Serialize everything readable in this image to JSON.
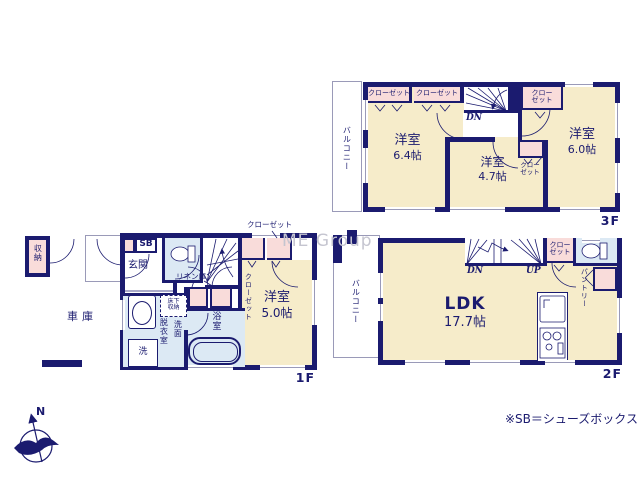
{
  "watermark": "ME Group",
  "footnote": "※SB＝シューズボックス",
  "compass": {
    "north": "N"
  },
  "colors": {
    "wall": "#1b1b6f",
    "room_fill": "#f6ecca",
    "closet_fill": "#f9dcda",
    "wet_area_fill": "#dce9f4",
    "balcony_outline": "#9a9ab8",
    "watermark": "#c5c5d0"
  },
  "floor3": {
    "label": "3F",
    "balcony": "バルコニー",
    "closet_a": "クローゼット",
    "closet_b": "クローゼット",
    "closet_c_line1": "クロー",
    "closet_c_line2": "ゼット",
    "closet_d_line1": "クロー",
    "closet_d_line2": "ゼット",
    "stairs_down": "DN",
    "room_a_name": "洋室",
    "room_a_size": "6.4帖",
    "room_b_name": "洋室",
    "room_b_size": "4.7帖",
    "room_c_name": "洋室",
    "room_c_size": "6.0帖"
  },
  "floor2": {
    "label": "2F",
    "balcony": "バルコニー",
    "stairs_down": "DN",
    "stairs_up": "UP",
    "closet_line1": "クロー",
    "closet_line2": "ゼット",
    "pantry": "パントリー",
    "ldk_name": "LDK",
    "ldk_size": "17.7帖"
  },
  "floor1": {
    "label": "1F",
    "storage": "収納",
    "garage": "車庫",
    "shoe_box": "SB",
    "entrance": "玄関",
    "stairs_up": "UP",
    "linen": "リネン庫",
    "closet_top": "クローゼット",
    "closet_side": "クローゼット",
    "underfloor_line1": "床下",
    "underfloor_line2": "収納",
    "dressing_room": "脱衣室",
    "washroom": "洗面",
    "laundry": "洗",
    "bathroom": "浴室",
    "room_name": "洋室",
    "room_size": "5.0帖"
  }
}
